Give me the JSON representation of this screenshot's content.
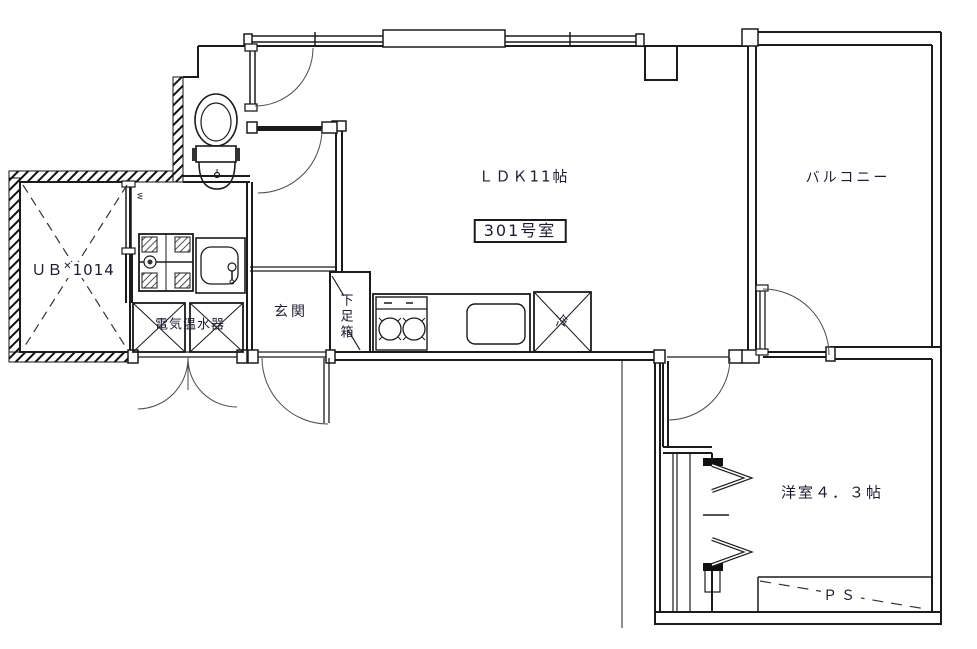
{
  "plan": {
    "unit": "301号室",
    "ldk": "ＬＤＫ11帖",
    "balcony": "バルコニー",
    "bedroom": "洋室４．３帖",
    "entrance": "玄関",
    "shoe_box": "下足箱",
    "ub_prefix": "ＵＢ",
    "ub_mark": "✕",
    "ub_size": "1014",
    "water_heater": "電気温水器",
    "fridge": "冷",
    "pipe_space": "ＰＳ",
    "door_mark": "w"
  },
  "colors": {
    "line": "#1b1b1b",
    "arc": "#4a4a4a",
    "text": "#1c1c30",
    "background": "#ffffff"
  }
}
